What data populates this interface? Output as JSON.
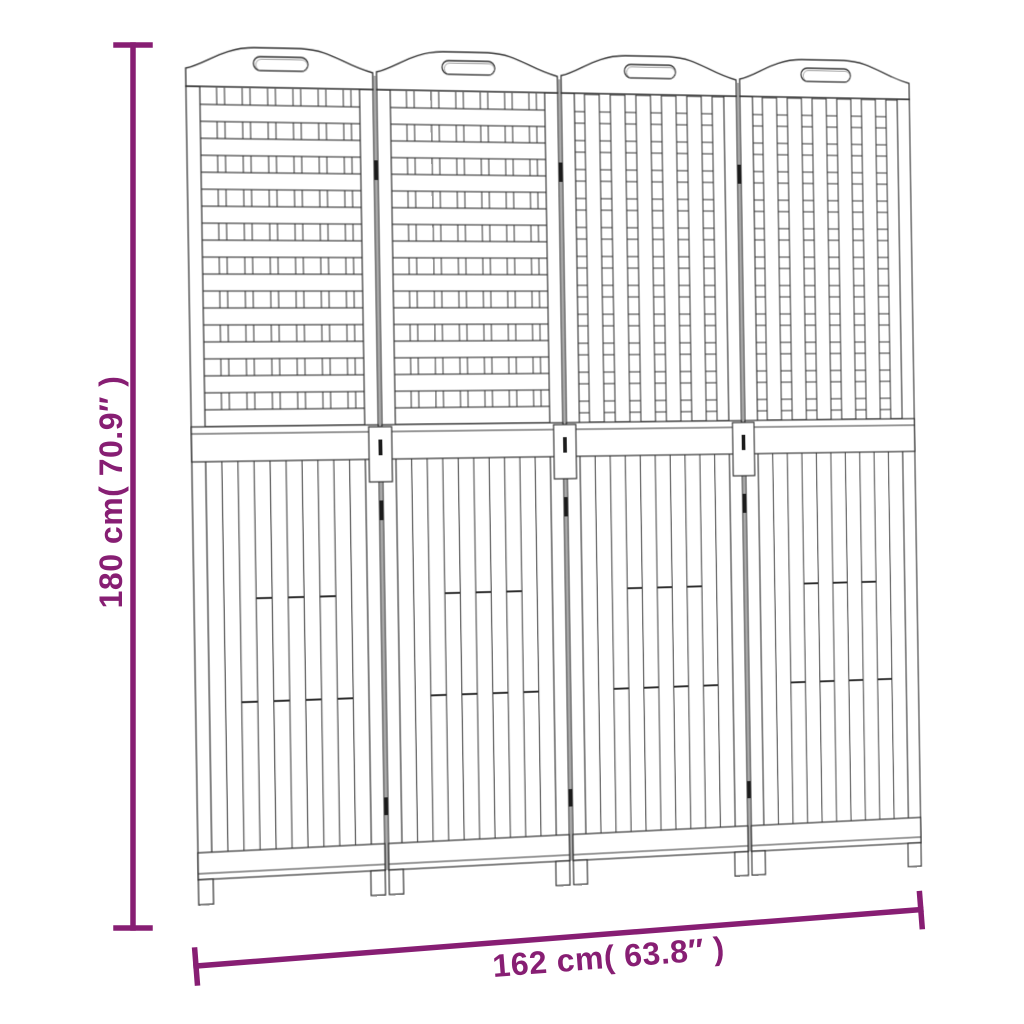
{
  "diagram": {
    "type": "product-dimension-diagram",
    "product": "4-panel wooden room divider",
    "panel_count": 4,
    "panel_patterns": [
      "horizontal",
      "horizontal",
      "vertical",
      "vertical"
    ],
    "height_dimension": {
      "label": "180 cm( 70.9″ )",
      "value_cm": 180,
      "value_inch": 70.9
    },
    "width_dimension": {
      "label": "162 cm( 63.8″ )",
      "value_cm": 162,
      "value_inch": 63.8
    },
    "colors": {
      "accent": "#871E73",
      "line": "#2e2e2e",
      "background": "#ffffff"
    }
  }
}
